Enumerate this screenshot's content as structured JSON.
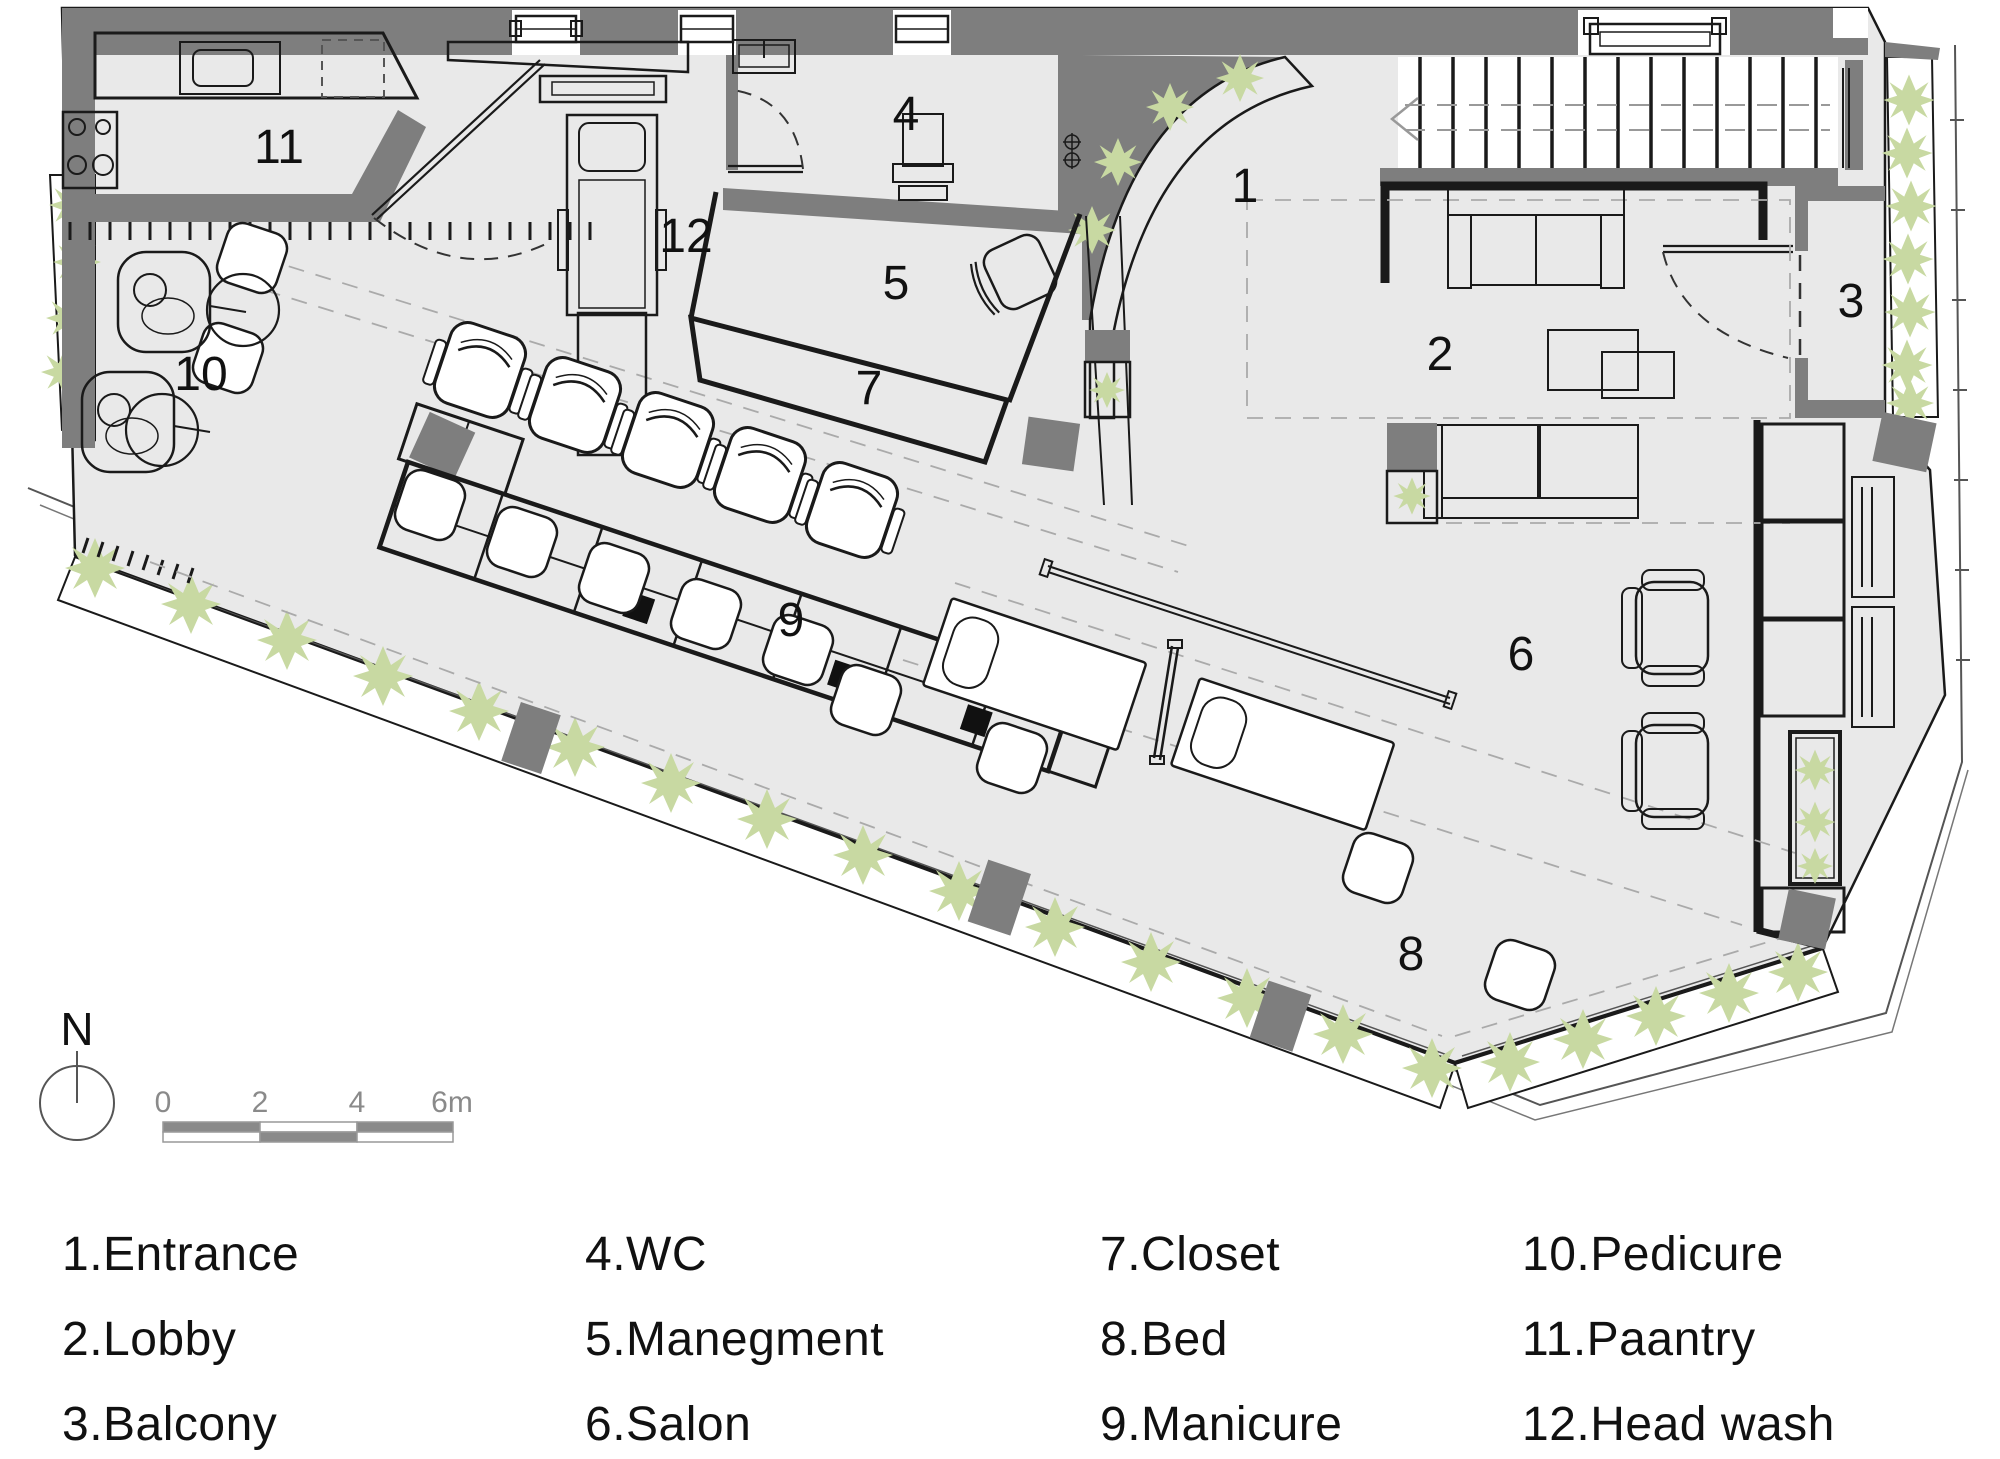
{
  "colors": {
    "wall": "#7e7e7e",
    "floor": "#e9e9e9",
    "plant": "#c8d9a2",
    "line": "#1a1a1a"
  },
  "plan": {
    "compass_label": "N",
    "scale": {
      "ticks": [
        "0",
        "2",
        "4",
        "6m"
      ]
    },
    "rooms": [
      {
        "number": "1",
        "name": "Entrance",
        "legend": "1.Entrance"
      },
      {
        "number": "2",
        "name": "Lobby",
        "legend": "2.Lobby"
      },
      {
        "number": "3",
        "name": "Balcony",
        "legend": "3.Balcony"
      },
      {
        "number": "4",
        "name": "WC",
        "legend": "4.WC"
      },
      {
        "number": "5",
        "name": "Manegment",
        "legend": "5.Manegment"
      },
      {
        "number": "6",
        "name": "Salon",
        "legend": "6.Salon"
      },
      {
        "number": "7",
        "name": "Closet",
        "legend": "7.Closet"
      },
      {
        "number": "8",
        "name": "Bed",
        "legend": "8.Bed"
      },
      {
        "number": "9",
        "name": "Manicure",
        "legend": "9.Manicure"
      },
      {
        "number": "10",
        "name": "Pedicure",
        "legend": "10.Pedicure"
      },
      {
        "number": "11",
        "name": "Paantry",
        "legend": "11.Paantry"
      },
      {
        "number": "12",
        "name": "Head wash",
        "legend": "12.Head wash"
      }
    ]
  }
}
